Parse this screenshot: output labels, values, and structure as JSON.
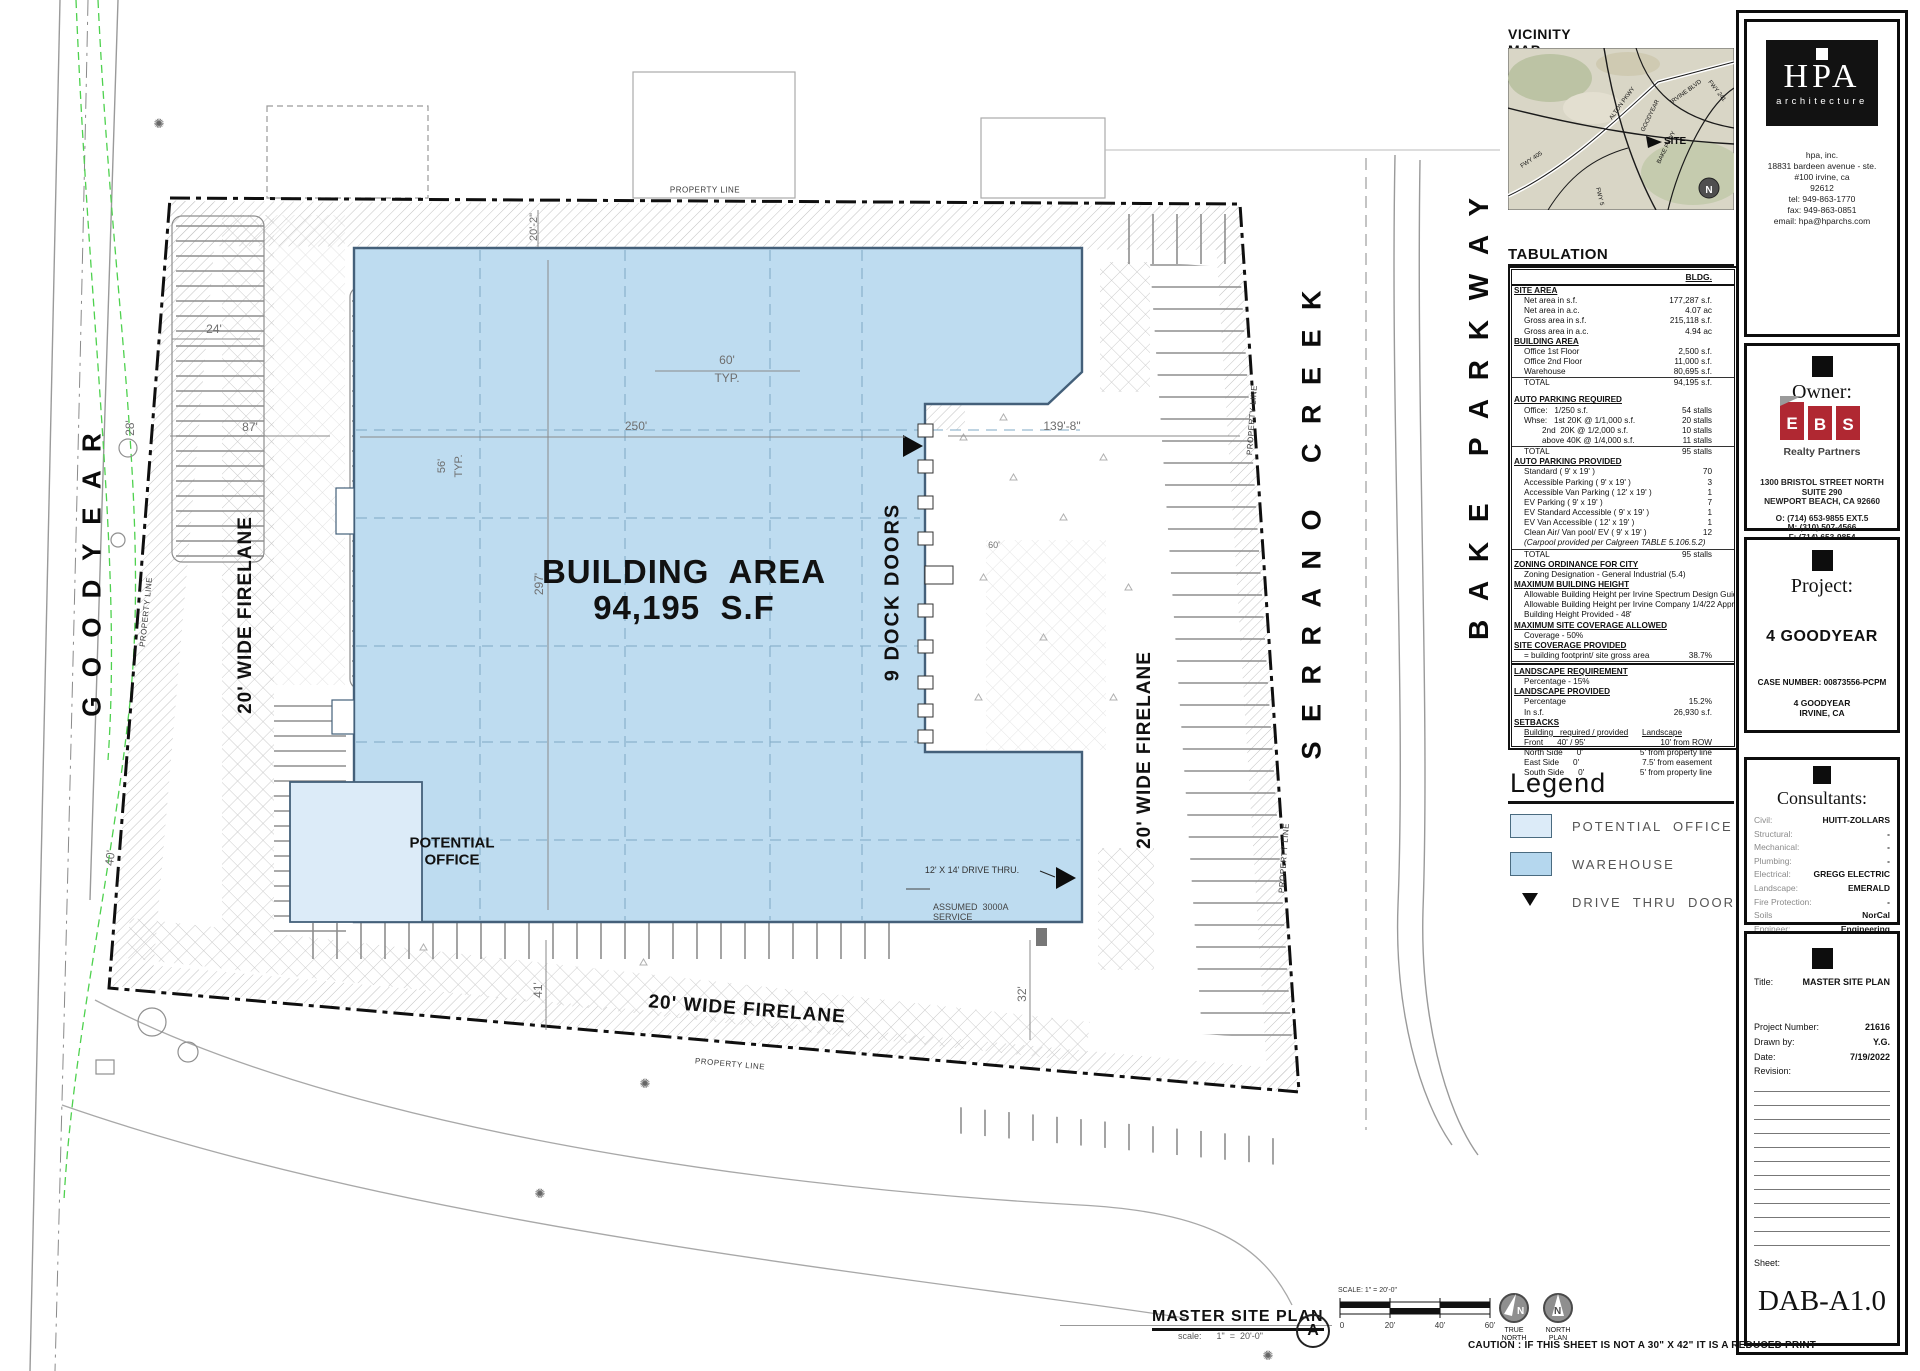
{
  "plan": {
    "roads": {
      "left": "G O O D Y E A R",
      "creek": "S E R R A N O   C R E E K",
      "parkway": "B A K E   P A R K W A Y"
    },
    "labels": {
      "building_area_l1": "BUILDING  AREA",
      "building_area_l2": "94,195  S.F",
      "potential_office_l1": "POTENTIAL",
      "potential_office_l2": "OFFICE",
      "dock_doors": "9 DOCK DOORS",
      "firelane": "20' WIDE FIRELANE",
      "drive_thru": "12' X 14' DRIVE THRU.",
      "assumed_service_l1": "ASSUMED  3000A",
      "assumed_service_l2": "SERVICE",
      "property_line": "PROPERTY LINE"
    },
    "dimensions": {
      "d20_2": "20'-2\"",
      "d24": "24'",
      "d87": "87'",
      "d28": "28'",
      "d60typ": "60'",
      "typ": "TYP.",
      "d250": "250'",
      "d139_8": "139'-8\"",
      "d56": "56'",
      "d297": "297'",
      "d40": "40'",
      "d41": "41'",
      "d32": "32'",
      "d60court": "60'"
    }
  },
  "vicinity": {
    "title": "VICINITY MAP",
    "site_label": "SITE",
    "roads": [
      "FWY 405",
      "FWY 5",
      "ALTON PKWY",
      "GOODYEAR",
      "BAKE PKWY",
      "IRVINE BLVD",
      "FWY 241"
    ]
  },
  "tabulation": {
    "title": "TABULATION",
    "col_header": "BLDG.",
    "sections": [
      {
        "t": "head",
        "l": "SITE AREA"
      },
      {
        "t": "row",
        "l": "Net area in s.f.",
        "v": "177,287 s.f."
      },
      {
        "t": "row",
        "l": "Net area in a.c.",
        "v": "4.07 ac"
      },
      {
        "t": "row",
        "l": "Gross area in s.f.",
        "v": "215,118 s.f."
      },
      {
        "t": "row",
        "l": "Gross area in a.c.",
        "v": "4.94 ac"
      },
      {
        "t": "head",
        "l": "BUILDING AREA"
      },
      {
        "t": "row",
        "l": "Office 1st Floor",
        "v": "2,500 s.f."
      },
      {
        "t": "row",
        "l": "Office 2nd Floor",
        "v": "11,000 s.f."
      },
      {
        "t": "row",
        "l": "Warehouse",
        "v": "80,695 s.f.",
        "u": 1
      },
      {
        "t": "total",
        "l": "TOTAL",
        "v": "94,195 s.f."
      },
      {
        "t": "gap"
      },
      {
        "t": "head",
        "l": "AUTO PARKING REQUIRED"
      },
      {
        "t": "row",
        "l": "Office:   1/250 s.f.",
        "v": "54 stalls"
      },
      {
        "t": "row",
        "l": "Whse:   1st 20K @ 1/1,000 s.f.",
        "v": "20 stalls"
      },
      {
        "t": "row2",
        "l": "2nd  20K @ 1/2,000 s.f.",
        "v": "10 stalls"
      },
      {
        "t": "row2",
        "l": "above 40K @ 1/4,000 s.f.",
        "v": "11 stalls",
        "u": 1
      },
      {
        "t": "total",
        "l": "TOTAL",
        "v": "95 stalls"
      },
      {
        "t": "head",
        "l": "AUTO PARKING PROVIDED"
      },
      {
        "t": "row",
        "l": "Standard ( 9' x 19' )",
        "v": "70"
      },
      {
        "t": "row",
        "l": "Accessible Parking ( 9' x 19' )",
        "v": "3"
      },
      {
        "t": "row",
        "l": "Accessible Van Parking ( 12' x 19' )",
        "v": "1"
      },
      {
        "t": "row",
        "l": "EV Parking ( 9' x 19' )",
        "v": "7"
      },
      {
        "t": "row",
        "l": "EV Standard Accessible ( 9' x 19' )",
        "v": "1"
      },
      {
        "t": "row",
        "l": "EV Van Accessible ( 12' x 19' )",
        "v": "1"
      },
      {
        "t": "row",
        "l": "Clean Air/ Van pool/ EV ( 9' x 19' )",
        "v": "12"
      },
      {
        "t": "note",
        "l": "(Carpool provided per Calgreen TABLE 5.106.5.2)",
        "u": 1
      },
      {
        "t": "total",
        "l": "TOTAL",
        "v": "95 stalls"
      },
      {
        "t": "head",
        "l": "ZONING ORDINANCE FOR CITY"
      },
      {
        "t": "row",
        "l": "Zoning Designation - General Industrial (5.4)"
      },
      {
        "t": "head",
        "l": "MAXIMUM BUILDING HEIGHT"
      },
      {
        "t": "row",
        "l": "Allowable Building Height per Irvine Spectrum Design Guidelines - 35'"
      },
      {
        "t": "row",
        "l": "Allowable Building Height per Irvine Company 1/4/22 Approval Letter - 48'"
      },
      {
        "t": "row",
        "l": "Building Height Provided - 48'"
      },
      {
        "t": "head",
        "l": "MAXIMUM SITE COVERAGE ALLOWED"
      },
      {
        "t": "row",
        "l": "Coverage - 50%"
      },
      {
        "t": "head",
        "l": "SITE COVERAGE PROVIDED"
      },
      {
        "t": "row",
        "l": "= building footprint/ site gross area",
        "v": "38.7%",
        "u": 1
      },
      {
        "t": "divider"
      },
      {
        "t": "head",
        "l": "LANDSCAPE REQUIREMENT"
      },
      {
        "t": "row",
        "l": "Percentage - 15%"
      },
      {
        "t": "head",
        "l": "LANDSCAPE PROVIDED"
      },
      {
        "t": "row",
        "l": "Percentage",
        "v": "15.2%"
      },
      {
        "t": "row",
        "l": "In s.f.",
        "v": "26,930 s.f."
      },
      {
        "t": "head",
        "l": "SETBACKS"
      },
      {
        "t": "sethead",
        "l": "Building   required / provided",
        "v": "Landscape"
      },
      {
        "t": "set",
        "l": "Front",
        "m": "40' / 95'",
        "v": "10' from ROW"
      },
      {
        "t": "set",
        "l": "North Side",
        "m": "0'",
        "v": "5' from property line"
      },
      {
        "t": "set",
        "l": "East Side",
        "m": "0'",
        "v": "7.5' from easement"
      },
      {
        "t": "set",
        "l": "South Side",
        "m": "0'",
        "v": "5' from property line"
      }
    ]
  },
  "legend": {
    "title": "Legend",
    "office_label": "POTENTIAL  OFFICE",
    "warehouse_label": "WAREHOUSE",
    "drive_thru_label": "DRIVE  THRU  DOOR"
  },
  "firm": {
    "name": "HPA",
    "tagline": "architecture",
    "lines": [
      "hpa,  inc.",
      "18831 bardeen avenue - ste.",
      "#100 irvine, ca",
      "92612",
      "tel: 949-863-1770",
      "fax: 949-863-0851",
      "email: hpa@hparchs.com"
    ]
  },
  "owner": {
    "heading": "Owner:",
    "logo_letters": [
      "E",
      "B",
      "S"
    ],
    "logo_sub": "Realty Partners",
    "address": [
      "1300 BRISTOL STREET NORTH",
      "SUITE 290",
      "NEWPORT BEACH, CA 92660"
    ],
    "phones": [
      "O: (714) 653-9855 EXT.5",
      "M: (310) 507-4566",
      "F: (714) 653-9854"
    ]
  },
  "project": {
    "heading": "Project:",
    "name": "4 GOODYEAR",
    "case_number": "CASE NUMBER: 00873556-PCPM",
    "site_lines": [
      "4 GOODYEAR",
      "IRVINE, CA"
    ]
  },
  "consultants": {
    "heading": "Consultants:",
    "rows": [
      [
        "Civil:",
        "HUITT-ZOLLARS"
      ],
      [
        "Structural:",
        "-"
      ],
      [
        "Mechanical:",
        "-"
      ],
      [
        "Plumbing:",
        "-"
      ],
      [
        "Electrical:",
        "GREGG ELECTRIC"
      ],
      [
        "Landscape:",
        "EMERALD"
      ],
      [
        "Fire Protection:",
        "-"
      ],
      [
        "Soils Engineer:",
        "NorCal Engineering"
      ]
    ]
  },
  "titleblock": {
    "title_label": "Title:",
    "title_value": "MASTER SITE PLAN",
    "fields": [
      [
        "Project Number:",
        "21616"
      ],
      [
        "Drawn by:",
        "Y.G."
      ],
      [
        "Date:",
        "7/19/2022"
      ]
    ],
    "revision_label": "Revision:",
    "sheet_label": "Sheet:",
    "sheet_number": "DAB-A1.0"
  },
  "footer": {
    "plan_title": "MASTER SITE PLAN",
    "plan_scale": "scale:      1\"  =  20'-0\"",
    "detail_letter": "A",
    "scalebar_label": "SCALE:  1\"  =  20'-0\"",
    "scalebar_ticks": [
      "0",
      "20'",
      "40'",
      "60'"
    ],
    "true_north_l1": "TRUE",
    "true_north_l2": "NORTH",
    "plan_north_l1": "NORTH",
    "plan_north_l2": "PLAN",
    "caution": "CAUTION : IF THIS SHEET IS NOT A 30\" X 42\" IT IS A REDUCED PRINT"
  },
  "colors": {
    "warehouse": "#bedcf0",
    "office": "#dcebf8",
    "accent_red": "#b02832",
    "landscape_green": "#4ed14e"
  }
}
